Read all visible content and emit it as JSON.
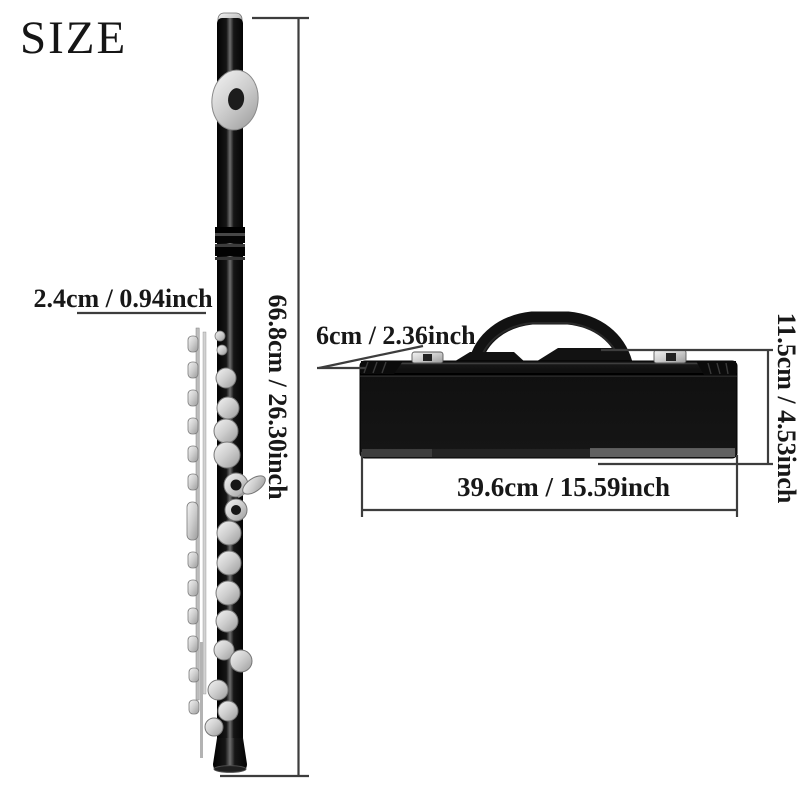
{
  "title": "SIZE",
  "flute": {
    "name": "flute",
    "length_label": "66.8cm / 26.30inch",
    "diameter_label": "2.4cm / 0.94inch"
  },
  "case": {
    "name": "flute-case",
    "depth_label": "6cm / 2.36inch",
    "height_label": "11.5cm / 4.53inch",
    "length_label": "39.6cm / 15.59inch"
  },
  "colors": {
    "background": "#ffffff",
    "text": "#181818",
    "measure_line": "#3d3d3d",
    "flute_body": "#0a0a0a",
    "key_silver": "#c9c9c9",
    "case_body": "#141414",
    "latch_silver": "#dedede"
  }
}
